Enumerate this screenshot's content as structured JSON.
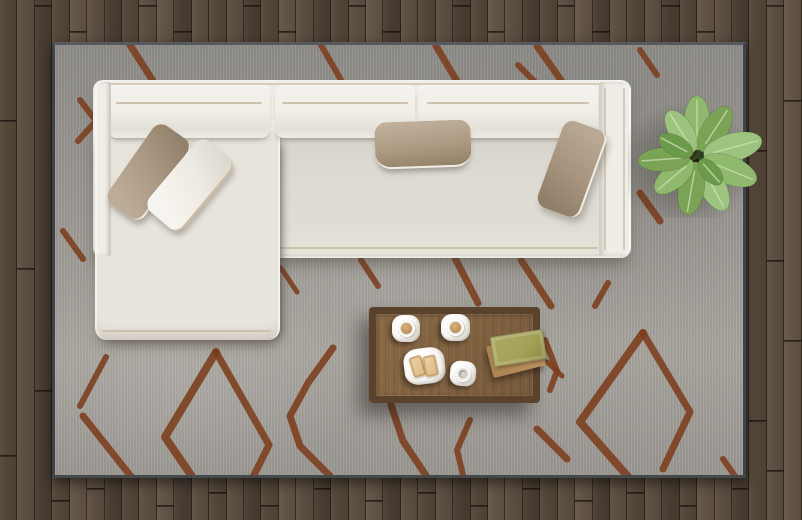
{
  "scene": {
    "width": 802,
    "height": 520,
    "alt": "Top view of a living room: white L-shaped sectional sofa with four pillows on a gray rug with rust diamond-line pattern, wooden coffee table holding two coffee cups, a plate with two toasts, an empty cup and two stacked books, and a green potted plant, all on dark wood plank flooring"
  },
  "palette": {
    "floor-shade-0": "#544739",
    "floor-shade-1": "#5d4f42",
    "floor-shade-2": "#4a3e33",
    "floor-shade-3": "#635547",
    "floor-gap": "rgba(16,11,6,0.6)",
    "floor-seam": "rgba(14,9,5,0.65)",
    "rug-base": "#9a9792",
    "rug-dark": "#8e8c88",
    "rug-light": "#a7a39d",
    "rug-binding": "#3d4349",
    "rug-pattern": "#7c3e1c",
    "sofa-shell": "#efede7",
    "sofa-cushion": "#f1efe9",
    "sofa-seat": "#dcd9d1",
    "sofa-chaise": "#e7e4dc",
    "sofa-piping": "#c7b69c",
    "sofa-shadow": "rgba(70,62,52,0.45)",
    "pillow-taupe": "#af9d88",
    "pillow-white": "#f0eee8",
    "table-frame": "#5a422d",
    "table-top": "#8a6a47",
    "table-top-dark": "#775a3b",
    "saucer": "#f7f6f2",
    "coffee": "#c29b66",
    "toast": "#e4c898",
    "book-top": "#a4a158",
    "book-top-edge": "#8c8947",
    "book-bottom": "#b78f5c",
    "leaf-0": "#8fb96d",
    "leaf-1": "#7aa355",
    "leaf-2": "#9dc47f",
    "leaf-3": "#6c9a4b",
    "leaf-vein": "#cfe0b2",
    "plant-core": "#2f3c22",
    "soil": "#3a2b1a",
    "soil-dark": "#241a10",
    "stem": "#2e4a24"
  },
  "floor": {
    "plank_width": 17.43,
    "shade_pattern": [
      0,
      1,
      2,
      0,
      3,
      1,
      2,
      0,
      1,
      3,
      2,
      1
    ],
    "seams": [
      [
        0,
        120
      ],
      [
        0,
        455
      ],
      [
        1,
        268
      ],
      [
        2,
        5
      ],
      [
        2,
        390
      ],
      [
        3,
        500
      ],
      [
        4,
        31
      ],
      [
        5,
        488
      ],
      [
        6,
        130
      ],
      [
        8,
        5
      ],
      [
        9,
        505
      ],
      [
        10,
        31
      ],
      [
        12,
        492
      ],
      [
        14,
        5
      ],
      [
        15,
        505
      ],
      [
        16,
        31
      ],
      [
        18,
        488
      ],
      [
        20,
        5
      ],
      [
        21,
        500
      ],
      [
        22,
        31
      ],
      [
        24,
        492
      ],
      [
        26,
        5
      ],
      [
        27,
        505
      ],
      [
        28,
        31
      ],
      [
        30,
        488
      ],
      [
        32,
        5
      ],
      [
        33,
        500
      ],
      [
        34,
        31
      ],
      [
        36,
        492
      ],
      [
        38,
        5
      ],
      [
        39,
        505
      ],
      [
        40,
        31
      ],
      [
        42,
        488
      ],
      [
        43,
        150
      ],
      [
        43,
        420
      ],
      [
        44,
        5
      ],
      [
        44,
        260
      ],
      [
        44,
        470
      ],
      [
        45,
        100
      ],
      [
        45,
        340
      ]
    ]
  },
  "rug": {
    "left": 52,
    "top": 42,
    "width": 694,
    "height": 436,
    "lines": [
      {
        "w": 7,
        "p": [
          [
            75,
            0
          ],
          [
            98,
            36
          ],
          [
            111,
            58
          ]
        ]
      },
      {
        "w": 6,
        "p": [
          [
            25,
            55
          ],
          [
            41,
            76
          ],
          [
            23,
            96
          ]
        ]
      },
      {
        "w": 6,
        "p": [
          [
            8,
            186
          ],
          [
            28,
            214
          ]
        ]
      },
      {
        "w": 6,
        "p": [
          [
            266,
            0
          ],
          [
            286,
            35
          ]
        ]
      },
      {
        "w": 7,
        "p": [
          [
            381,
            1
          ],
          [
            403,
            38
          ]
        ]
      },
      {
        "w": 6,
        "p": [
          [
            463,
            20
          ],
          [
            481,
            38
          ]
        ]
      },
      {
        "w": 7,
        "p": [
          [
            482,
            1
          ],
          [
            508,
            38
          ]
        ]
      },
      {
        "w": 6,
        "p": [
          [
            585,
            5
          ],
          [
            602,
            30
          ]
        ]
      },
      {
        "w": 7,
        "p": [
          [
            585,
            148
          ],
          [
            605,
            176
          ]
        ]
      },
      {
        "w": 8,
        "p": [
          [
            588,
            288
          ],
          [
            525,
            377
          ],
          [
            575,
            434
          ]
        ]
      },
      {
        "w": 7,
        "p": [
          [
            588,
            288
          ],
          [
            635,
            367
          ],
          [
            608,
            424
          ]
        ]
      },
      {
        "w": 7,
        "p": [
          [
            466,
            215
          ],
          [
            496,
            261
          ]
        ]
      },
      {
        "w": 8,
        "p": [
          [
            161,
            307
          ],
          [
            110,
            392
          ],
          [
            140,
            436
          ]
        ]
      },
      {
        "w": 7,
        "p": [
          [
            161,
            307
          ],
          [
            214,
            400
          ],
          [
            196,
            436
          ]
        ]
      },
      {
        "w": 6,
        "p": [
          [
            51,
            312
          ],
          [
            25,
            361
          ]
        ]
      },
      {
        "w": 7,
        "p": [
          [
            28,
            371
          ],
          [
            78,
            434
          ]
        ]
      },
      {
        "w": 5,
        "p": [
          [
            146,
            233
          ],
          [
            170,
            256
          ]
        ]
      },
      {
        "w": 5,
        "p": [
          [
            226,
            223
          ],
          [
            242,
            247
          ]
        ]
      },
      {
        "w": 6,
        "p": [
          [
            306,
            215
          ],
          [
            323,
            241
          ]
        ]
      },
      {
        "w": 7,
        "p": [
          [
            400,
            213
          ],
          [
            423,
            258
          ]
        ]
      },
      {
        "w": 6,
        "p": [
          [
            553,
            238
          ],
          [
            540,
            261
          ]
        ]
      },
      {
        "w": 6,
        "p": [
          [
            490,
            295
          ],
          [
            502,
            326
          ],
          [
            495,
            345
          ]
        ]
      },
      {
        "w": 6,
        "p": [
          [
            415,
            375
          ],
          [
            402,
            405
          ],
          [
            408,
            430
          ]
        ]
      },
      {
        "w": 7,
        "p": [
          [
            278,
            303
          ],
          [
            253,
            338
          ],
          [
            235,
            371
          ],
          [
            245,
            401
          ],
          [
            275,
            431
          ]
        ]
      },
      {
        "w": 7,
        "p": [
          [
            336,
            360
          ],
          [
            348,
            396
          ],
          [
            372,
            432
          ]
        ]
      },
      {
        "w": 7,
        "p": [
          [
            482,
            384
          ],
          [
            512,
            414
          ]
        ]
      },
      {
        "w": 6,
        "p": [
          [
            668,
            414
          ],
          [
            682,
            434
          ]
        ]
      },
      {
        "w": 5,
        "p": [
          [
            492,
            317
          ],
          [
            507,
            331
          ]
        ]
      }
    ]
  },
  "sofa": {
    "back_cushions": 3,
    "throw_pillows": 4,
    "style": "L-shaped sectional with left chaise"
  },
  "table": {
    "items": [
      "coffee cup on saucer",
      "coffee cup on saucer",
      "plate with two toasts",
      "empty white cup",
      "two stacked books"
    ]
  },
  "plant": {
    "cx": 78,
    "cy": 78,
    "stems": [
      {
        "a": -70,
        "len": 14
      },
      {
        "a": 25,
        "len": 12
      },
      {
        "a": 150,
        "len": 13
      }
    ],
    "leaves": [
      {
        "a": -90,
        "d": 34,
        "rx": 27,
        "ry": 13,
        "c": 0
      },
      {
        "a": -122,
        "d": 30,
        "rx": 24,
        "ry": 12,
        "c": 2
      },
      {
        "a": -57,
        "d": 33,
        "rx": 26,
        "ry": 13,
        "c": 1
      },
      {
        "a": -15,
        "d": 37,
        "rx": 30,
        "ry": 14,
        "c": 2
      },
      {
        "a": 22,
        "d": 35,
        "rx": 29,
        "ry": 14,
        "c": 0
      },
      {
        "a": 62,
        "d": 33,
        "rx": 27,
        "ry": 13,
        "c": 2
      },
      {
        "a": 100,
        "d": 32,
        "rx": 27,
        "ry": 13,
        "c": 1
      },
      {
        "a": 140,
        "d": 30,
        "rx": 24,
        "ry": 12,
        "c": 0
      },
      {
        "a": 176,
        "d": 33,
        "rx": 26,
        "ry": 12,
        "c": 1
      },
      {
        "a": -152,
        "d": 24,
        "rx": 19,
        "ry": 10,
        "c": 3
      },
      {
        "a": 48,
        "d": 20,
        "rx": 16,
        "ry": 9,
        "c": 3
      }
    ]
  }
}
